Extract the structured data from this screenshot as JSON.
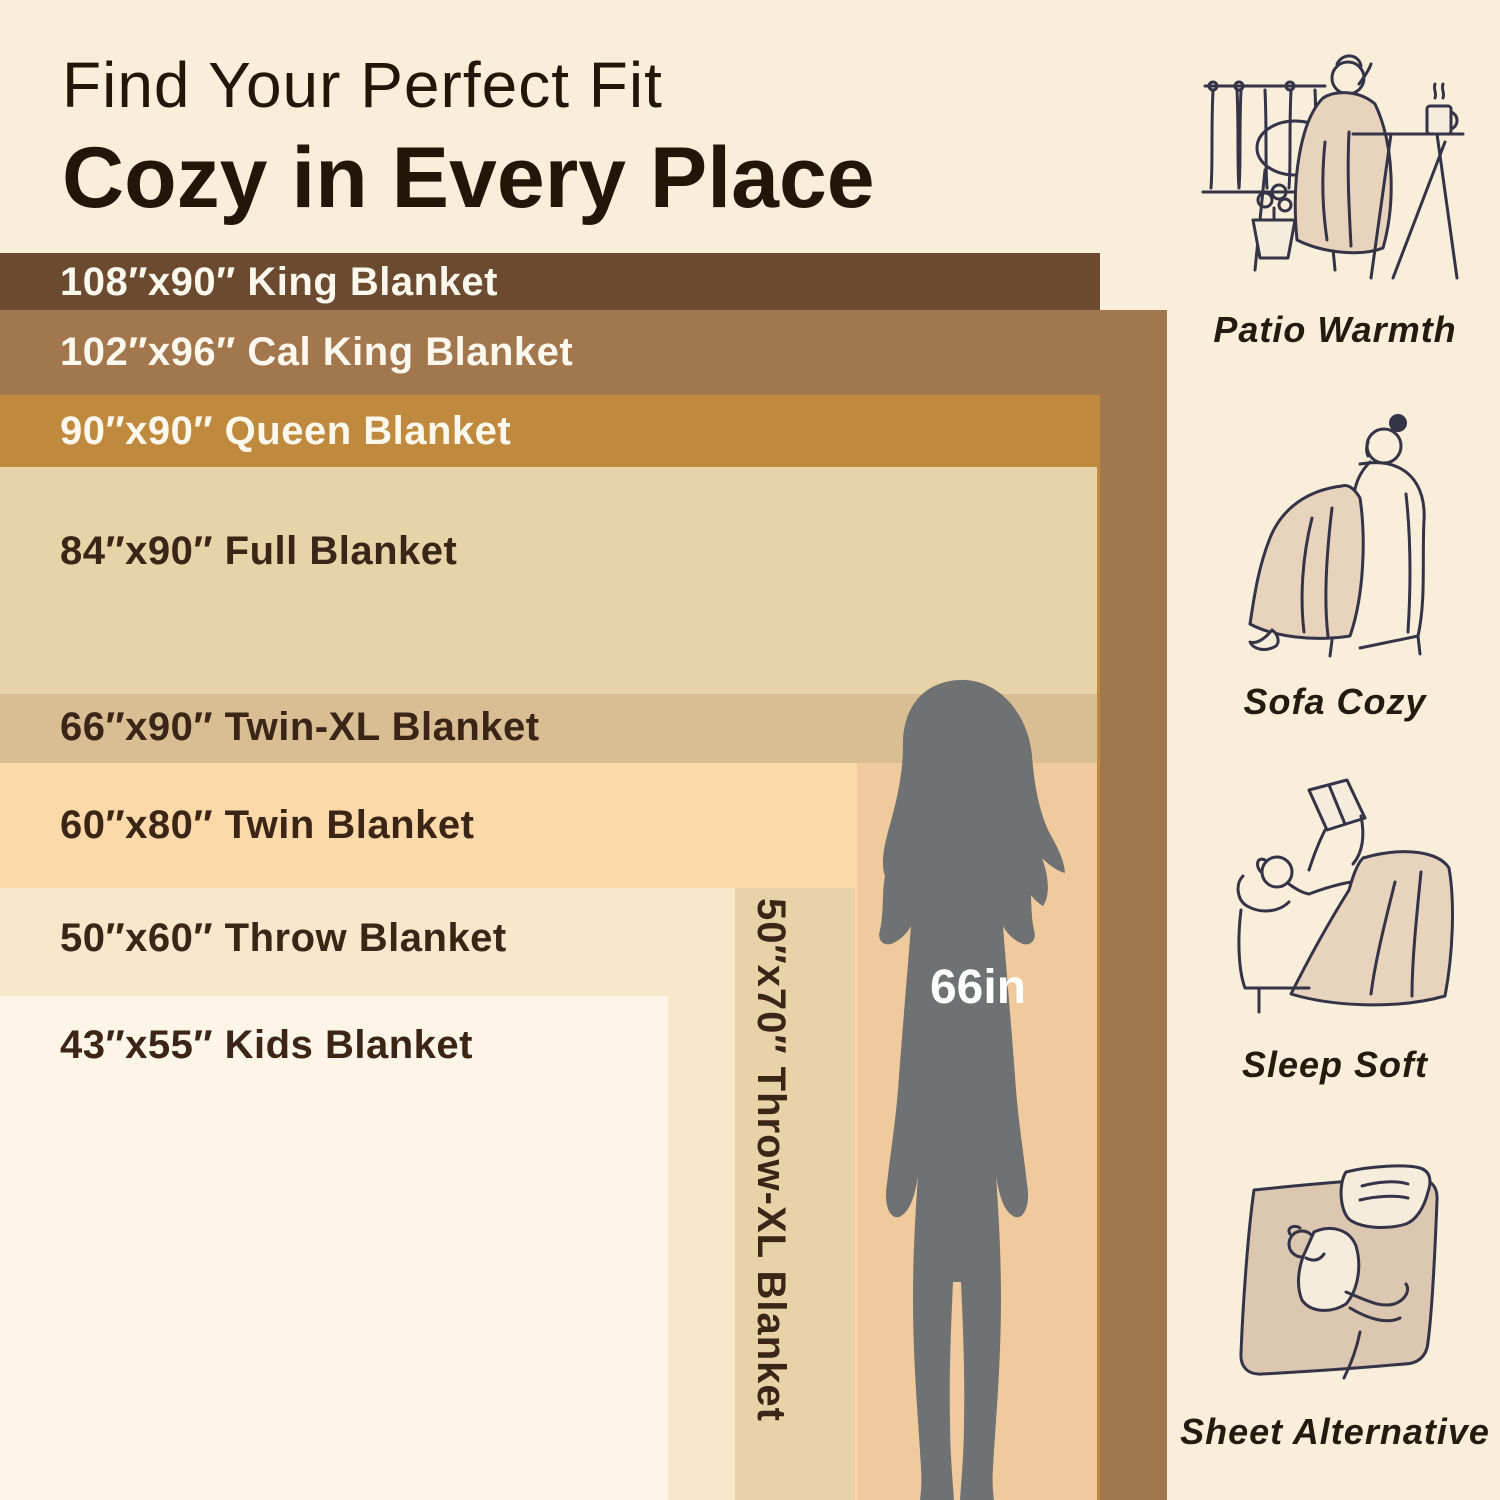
{
  "title": {
    "line1": "Find Your Perfect Fit",
    "line2": "Cozy in Every Place"
  },
  "blankets": [
    {
      "size": "108″x90″",
      "name": "King Blanket",
      "label": "108″x90″ King Blanket",
      "color": "#6b4a2f",
      "text_color": "#fdf8ee"
    },
    {
      "size": "102″x96″",
      "name": "Cal King Blanket",
      "label": "102″x96″ Cal King Blanket",
      "color": "#a3774e",
      "text_color": "#fdf8ee"
    },
    {
      "size": "90″x90″",
      "name": "Queen Blanket",
      "label": "90″x90″ Queen Blanket",
      "color": "#c08a3e",
      "text_color": "#fdf8ee"
    },
    {
      "size": "84″x90″",
      "name": "Full Blanket",
      "label": "84″x90″ Full Blanket",
      "color": "#e8d3a8",
      "text_color": "#3a2516"
    },
    {
      "size": "66″x90″",
      "name": "Twin-XL Blanket",
      "label": "66″x90″ Twin-XL Blanket",
      "color": "#d9bd93",
      "text_color": "#3a2516"
    },
    {
      "size": "60″x80″",
      "name": "Twin Blanket",
      "label": "60″x80″ Twin Blanket",
      "color": "#fcd9a8",
      "text_color": "#3a2516"
    },
    {
      "size": "50″x60″",
      "name": "Throw Blanket",
      "label": "50″x60″ Throw Blanket",
      "color": "#f9e7cb",
      "text_color": "#3a2516"
    },
    {
      "size": "43″x55″",
      "name": "Kids Blanket",
      "label": "43″x55″ Kids Blanket",
      "color": "#fdf5e8",
      "text_color": "#3a2516"
    },
    {
      "size": "50″x70″",
      "name": "Throw-XL Blanket",
      "label": "50″x70″ Throw-XL Blanket",
      "color": "#ead2a8",
      "text_color": "#3a2516",
      "orientation": "vertical"
    }
  ],
  "figure": {
    "height_label": "66in",
    "silhouette_color": "#6f7172",
    "backdrop_color": "#eeca9c"
  },
  "uses": [
    {
      "label": "Patio Warmth",
      "icon": "patio-scene-illustration"
    },
    {
      "label": "Sofa Cozy",
      "icon": "sofa-scene-illustration"
    },
    {
      "label": "Sleep Soft",
      "icon": "sleep-scene-illustration"
    },
    {
      "label": "Sheet Alternative",
      "icon": "sheet-scene-illustration"
    }
  ],
  "colors": {
    "background": "#f8eed9",
    "title_text": "#241509",
    "band_text_dark": "#3a2516",
    "band_text_light": "#fdf8ee",
    "illustration_ink": "#343347",
    "illustration_blanket": "#e8d4bc"
  }
}
